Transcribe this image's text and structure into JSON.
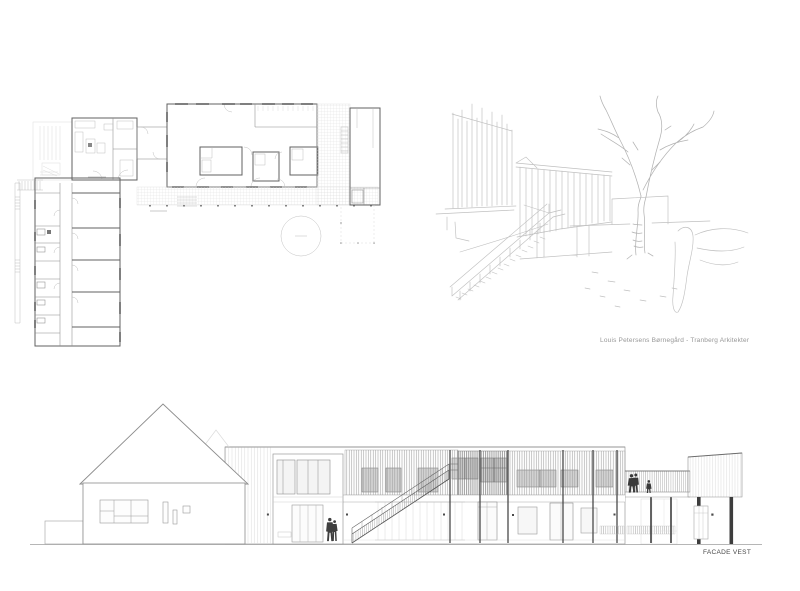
{
  "captions": {
    "credit": "Louis Petersens Børnegård - Tranberg Arkitekter",
    "facade_label": "FACADE VEST"
  },
  "colors": {
    "background": "#ffffff",
    "plan_wall_line": "#606060",
    "plan_light_line": "#b8b8b8",
    "sketch_line": "#bfbfbf",
    "elevation_line": "#8c8c8c",
    "dark_detail": "#3d3d3d",
    "credit_text": "#979797",
    "facade_label_text": "#474747"
  }
}
